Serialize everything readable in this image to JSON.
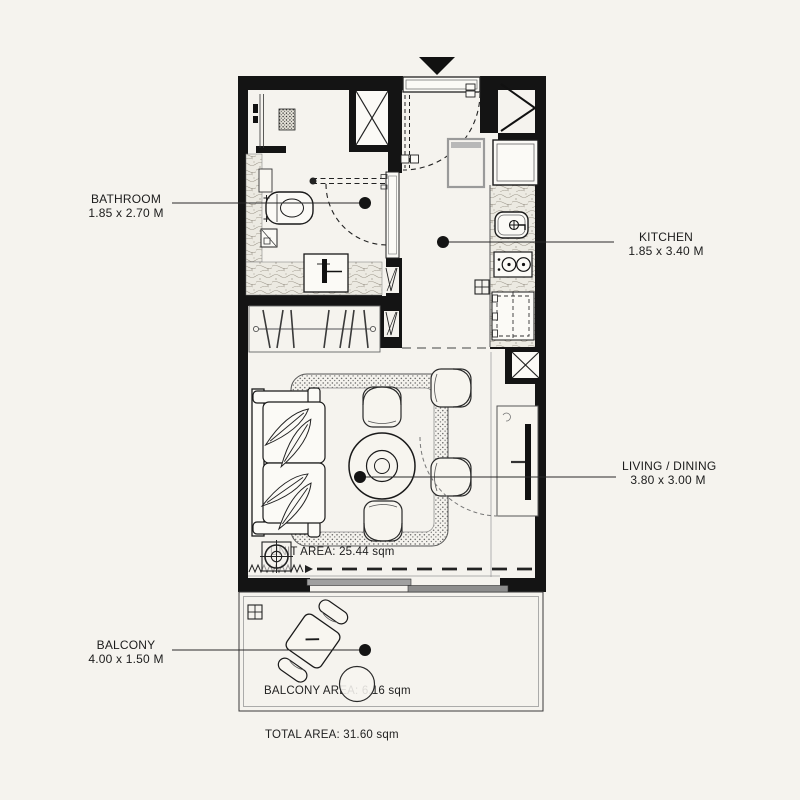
{
  "canvas": {
    "background": "#f5f3ee"
  },
  "colors": {
    "wall": "#141414",
    "line": "#333333",
    "hatch": "#a09a8e",
    "door_gray": "#9c9c9c"
  },
  "rooms": {
    "bathroom": {
      "label": "BATHROOM",
      "dimensions": "1.85 x 2.70 M"
    },
    "kitchen": {
      "label": "KITCHEN",
      "dimensions": "1.85 x 3.40 M"
    },
    "living_dining": {
      "label": "LIVING / DINING",
      "dimensions": "3.80 x 3.00 M"
    },
    "balcony": {
      "label": "BALCONY",
      "dimensions": "4.00 x 1.50 M"
    }
  },
  "areas": {
    "unit": "UNIT AREA: 25.44 sqm",
    "balcony": "BALCONY AREA: 6.16 sqm",
    "total": "TOTAL AREA: 31.60 sqm"
  },
  "symbols": {
    "entry_marker": "filled-triangle-down",
    "shaft": "box-with-x-cross",
    "unit_locator": "crosshair-circle",
    "floor_drain": "grid-square"
  }
}
